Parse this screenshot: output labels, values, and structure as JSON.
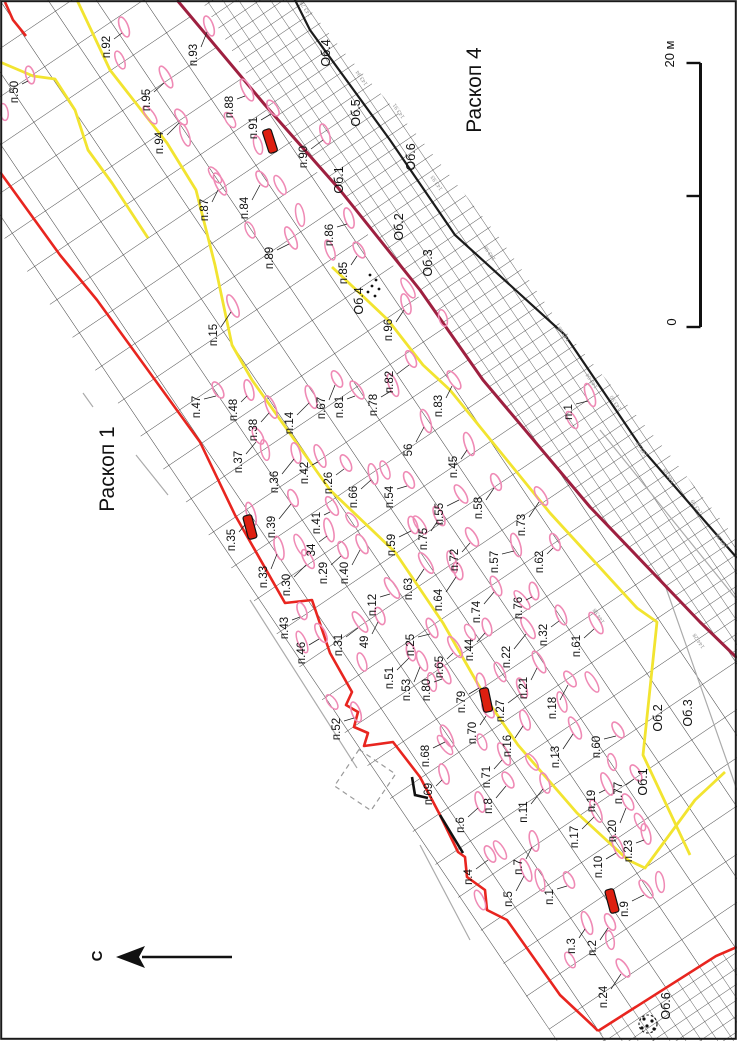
{
  "meta": {
    "width": 737,
    "height": 1041
  },
  "colors": {
    "red": "#e8251f",
    "maroon": "#9e2040",
    "yellow": "#f2e430",
    "pink": "#ef8ab5",
    "grid_big": "#3c3c3c",
    "grid_fine": "#333333",
    "gray": "#ababab",
    "text": "#111111",
    "elevation": "#9a9a9a",
    "red_fill": "#dd1f10"
  },
  "titles": [
    {
      "text": "Раскоп 1",
      "x": 114,
      "y": 469,
      "size": 21
    },
    {
      "text": "Раскоп 4",
      "x": 481,
      "y": 90,
      "size": 21
    }
  ],
  "north": {
    "label": "С",
    "x": 102,
    "y": 956,
    "shaft": [
      232,
      957,
      142,
      957
    ],
    "head": [
      [
        116,
        957
      ],
      [
        145,
        946
      ],
      [
        139,
        957
      ],
      [
        145,
        968
      ]
    ]
  },
  "scale_bar": {
    "x": 700.5,
    "y_top": 63,
    "y_mid": 196,
    "y_bottom": 327,
    "tick_len": 14,
    "label_top": "20 м",
    "label_top_x": 674,
    "label_top_y": 54,
    "label_bottom": "0",
    "label_bottom_x": 676,
    "label_bottom_y": 322
  },
  "grid": {
    "big_cell": 40,
    "fine_cell": 13.2,
    "angle": 56
  },
  "areas": {
    "big_grid": "0,0 177,0 470,360 737,640 737,1041 557,1041 -33,184",
    "fine_strip": "177,-40 265,105 340,190 420,290 483,380 590,507 700,622 737,658 737,540 669,454 562,327 499,237 419,137 344,52 270,-40",
    "fine_corner": "598,1031 716,956 737,947 737,1041 610,1041"
  },
  "lines": {
    "red_main": "0,172 60,255 97,300 150,373 200,442 235,515 285,603 312,600 330,653 352,692 346,705 358,712 354,727 368,733 364,746 393,742 420,777 440,815 458,852 465,857 467,877 485,890 487,910 507,920 560,995 592,1025 598,1031",
    "red_corner_seg": "5,2 13,20 26,36",
    "red_patch": "598,1031 716,956 737,947",
    "maroon_edge": "177,0 265,105 340,190 420,290 483,380 590,507 700,622 737,658",
    "dark_edge": "290,-10 310,30 390,140 455,235 565,335 643,450 723,542 737,558",
    "yellows": [
      "77,0 110,70 167,143 196,190 215,265 232,345 252,380 330,490 395,552 443,623 487,700 518,745 577,813 628,860 645,868 695,800 725,772",
      "0,62 33,76 55,79 75,110 88,150 112,183 148,238",
      "332,267 388,320 423,365 450,390 550,513 637,608 657,622 643,755 690,855"
    ],
    "grays": [
      "83,393 93,407",
      "136,455 168,495",
      "250,600 357,768",
      "420,845 470,940",
      "600,430 737,600",
      "665,585 737,790"
    ],
    "blacks": [
      "412,777 415,795 428,798",
      "440,815 463,853"
    ]
  },
  "dashed_square": {
    "x": 365,
    "y": 780,
    "size": 44,
    "angle": 34
  },
  "red_rects": [
    {
      "x": 270,
      "y": 141,
      "angle": -18
    },
    {
      "x": 250,
      "y": 527,
      "angle": -15
    },
    {
      "x": 486,
      "y": 700,
      "angle": -12
    },
    {
      "x": 612,
      "y": 901,
      "angle": -15
    }
  ],
  "dot_cluster": [
    [
      370,
      275
    ],
    [
      376,
      280
    ],
    [
      372,
      286
    ],
    [
      379,
      289
    ],
    [
      368,
      292
    ],
    [
      375,
      296
    ]
  ],
  "dotted_circle": {
    "x": 648,
    "y": 1024,
    "r": 9,
    "dots": [
      [
        644,
        1019
      ],
      [
        652,
        1021
      ],
      [
        647,
        1026
      ],
      [
        654,
        1029
      ],
      [
        642,
        1028
      ]
    ]
  },
  "burials": [
    {
      "t": "п.50",
      "x": 18,
      "y": 92
    },
    {
      "t": "п.92",
      "x": 110,
      "y": 47
    },
    {
      "t": "п.95",
      "x": 150,
      "y": 100
    },
    {
      "t": "п.94",
      "x": 163,
      "y": 143
    },
    {
      "t": "п.93",
      "x": 197,
      "y": 55
    },
    {
      "t": "п.88",
      "x": 233,
      "y": 107
    },
    {
      "t": "п.91",
      "x": 257,
      "y": 128
    },
    {
      "t": "п.90",
      "x": 307,
      "y": 157
    },
    {
      "t": "п.87",
      "x": 208,
      "y": 210
    },
    {
      "t": "п.84",
      "x": 248,
      "y": 208
    },
    {
      "t": "п.86",
      "x": 333,
      "y": 235
    },
    {
      "t": "п.89",
      "x": 273,
      "y": 258
    },
    {
      "t": "п.85",
      "x": 347,
      "y": 273
    },
    {
      "t": "п.96",
      "x": 392,
      "y": 330
    },
    {
      "t": "п.15",
      "x": 217,
      "y": 335
    },
    {
      "t": "п.47",
      "x": 200,
      "y": 407
    },
    {
      "t": "п.48",
      "x": 237,
      "y": 410
    },
    {
      "t": "п.38",
      "x": 257,
      "y": 430
    },
    {
      "t": "п.37",
      "x": 242,
      "y": 462
    },
    {
      "t": "п.36",
      "x": 278,
      "y": 482
    },
    {
      "t": "п.42",
      "x": 308,
      "y": 473
    },
    {
      "t": "п.26",
      "x": 332,
      "y": 483
    },
    {
      "t": "п.66",
      "x": 357,
      "y": 497
    },
    {
      "t": "п.14",
      "x": 293,
      "y": 423
    },
    {
      "t": "п.67",
      "x": 325,
      "y": 408
    },
    {
      "t": "п.81",
      "x": 343,
      "y": 407
    },
    {
      "t": "п.78",
      "x": 377,
      "y": 405
    },
    {
      "t": "п.82",
      "x": 393,
      "y": 382
    },
    {
      "t": "п.83",
      "x": 442,
      "y": 406
    },
    {
      "t": "56",
      "x": 412,
      "y": 450
    },
    {
      "t": "п.54",
      "x": 393,
      "y": 497
    },
    {
      "t": "п.55",
      "x": 443,
      "y": 514
    },
    {
      "t": "п.45",
      "x": 457,
      "y": 467
    },
    {
      "t": "п.58",
      "x": 482,
      "y": 508
    },
    {
      "t": "п.73",
      "x": 525,
      "y": 525
    },
    {
      "t": "п.57",
      "x": 498,
      "y": 562
    },
    {
      "t": "п.62",
      "x": 543,
      "y": 562
    },
    {
      "t": "п.72",
      "x": 458,
      "y": 560
    },
    {
      "t": "п.35",
      "x": 235,
      "y": 540
    },
    {
      "t": "п.39",
      "x": 275,
      "y": 527
    },
    {
      "t": "п.41",
      "x": 320,
      "y": 523
    },
    {
      "t": "34",
      "x": 315,
      "y": 550
    },
    {
      "t": "п.29",
      "x": 327,
      "y": 573
    },
    {
      "t": "п.30",
      "x": 290,
      "y": 585
    },
    {
      "t": "п.33",
      "x": 267,
      "y": 577
    },
    {
      "t": "п.43",
      "x": 288,
      "y": 628
    },
    {
      "t": "п.46",
      "x": 305,
      "y": 653
    },
    {
      "t": "п.31",
      "x": 342,
      "y": 645
    },
    {
      "t": "49",
      "x": 368,
      "y": 642
    },
    {
      "t": "п.40",
      "x": 348,
      "y": 573
    },
    {
      "t": "п.12",
      "x": 376,
      "y": 605
    },
    {
      "t": "п.59",
      "x": 395,
      "y": 545
    },
    {
      "t": "п.75",
      "x": 427,
      "y": 539
    },
    {
      "t": "п.63",
      "x": 412,
      "y": 589
    },
    {
      "t": "п.64",
      "x": 442,
      "y": 600
    },
    {
      "t": "п.25",
      "x": 414,
      "y": 645
    },
    {
      "t": "п.65",
      "x": 443,
      "y": 667
    },
    {
      "t": "п.44",
      "x": 473,
      "y": 650
    },
    {
      "t": "п.74",
      "x": 480,
      "y": 612
    },
    {
      "t": "п.22",
      "x": 510,
      "y": 657
    },
    {
      "t": "п.76",
      "x": 522,
      "y": 608
    },
    {
      "t": "п.32",
      "x": 547,
      "y": 635
    },
    {
      "t": "п.61",
      "x": 580,
      "y": 646
    },
    {
      "t": "п.51",
      "x": 393,
      "y": 678
    },
    {
      "t": "п.53",
      "x": 410,
      "y": 690
    },
    {
      "t": "п.80",
      "x": 430,
      "y": 690
    },
    {
      "t": "п.79",
      "x": 465,
      "y": 702
    },
    {
      "t": "п.27",
      "x": 504,
      "y": 711
    },
    {
      "t": "п.21",
      "x": 527,
      "y": 688
    },
    {
      "t": "п.18",
      "x": 556,
      "y": 708
    },
    {
      "t": "п.52",
      "x": 340,
      "y": 729
    },
    {
      "t": "п.68",
      "x": 429,
      "y": 756
    },
    {
      "t": "п.70",
      "x": 476,
      "y": 733
    },
    {
      "t": "п.16",
      "x": 511,
      "y": 746
    },
    {
      "t": "п.13",
      "x": 559,
      "y": 757
    },
    {
      "t": "п.60",
      "x": 600,
      "y": 747
    },
    {
      "t": "п.69",
      "x": 432,
      "y": 794
    },
    {
      "t": "п.71",
      "x": 490,
      "y": 777
    },
    {
      "t": "п.8",
      "x": 492,
      "y": 806
    },
    {
      "t": "п.11",
      "x": 527,
      "y": 812
    },
    {
      "t": "п.19",
      "x": 595,
      "y": 801
    },
    {
      "t": "п.77",
      "x": 622,
      "y": 793
    },
    {
      "t": "п.6",
      "x": 464,
      "y": 825
    },
    {
      "t": "п.17",
      "x": 578,
      "y": 837
    },
    {
      "t": "п.20",
      "x": 616,
      "y": 831
    },
    {
      "t": "п.23",
      "x": 632,
      "y": 851
    },
    {
      "t": "п.10",
      "x": 602,
      "y": 867
    },
    {
      "t": "п.4",
      "x": 472,
      "y": 877
    },
    {
      "t": "п.7",
      "x": 522,
      "y": 867
    },
    {
      "t": "п.5",
      "x": 512,
      "y": 899
    },
    {
      "t": "п.1",
      "x": 553,
      "y": 897
    },
    {
      "t": "п.9",
      "x": 628,
      "y": 909
    },
    {
      "t": "п.3",
      "x": 575,
      "y": 946
    },
    {
      "t": "п.2",
      "x": 596,
      "y": 948
    },
    {
      "t": "п.24",
      "x": 607,
      "y": 997
    },
    {
      "t": "п.1",
      "x": 572,
      "y": 412
    }
  ],
  "objects": [
    {
      "t": "Об.4",
      "x": 330,
      "y": 53
    },
    {
      "t": "Об.5",
      "x": 360,
      "y": 113
    },
    {
      "t": "Об.1",
      "x": 343,
      "y": 180
    },
    {
      "t": "Об.6",
      "x": 415,
      "y": 157
    },
    {
      "t": "Об.2",
      "x": 403,
      "y": 227
    },
    {
      "t": "Об.3",
      "x": 432,
      "y": 263
    },
    {
      "t": "Об.4",
      "x": 363,
      "y": 301
    },
    {
      "t": "Об.2",
      "x": 662,
      "y": 718
    },
    {
      "t": "Об.3",
      "x": 692,
      "y": 713
    },
    {
      "t": "Об.1",
      "x": 647,
      "y": 782
    },
    {
      "t": "Об.6",
      "x": 670,
      "y": 1006
    }
  ],
  "elevations": [
    {
      "t": "143.78",
      "x": 307,
      "y": 8
    },
    {
      "t": "143.94",
      "x": 363,
      "y": 77
    },
    {
      "t": "143.91",
      "x": 400,
      "y": 110
    },
    {
      "t": "143.93",
      "x": 438,
      "y": 182
    },
    {
      "t": "143.98",
      "x": 491,
      "y": 252
    },
    {
      "t": "143.98",
      "x": 565,
      "y": 333
    },
    {
      "t": "143.64",
      "x": 593,
      "y": 380
    },
    {
      "t": "143.90",
      "x": 617,
      "y": 402
    },
    {
      "t": "145.02",
      "x": 643,
      "y": 448
    },
    {
      "t": "144.38",
      "x": 670,
      "y": 475
    },
    {
      "t": "143.99",
      "x": 698,
      "y": 506
    },
    {
      "t": "145.38",
      "x": 723,
      "y": 540
    },
    {
      "t": "144.58",
      "x": 600,
      "y": 615
    },
    {
      "t": "144.28",
      "x": 700,
      "y": 640
    }
  ],
  "extra_graves": [
    [
      4,
      112
    ],
    [
      120,
      60
    ],
    [
      150,
      115
    ],
    [
      185,
      135
    ],
    [
      230,
      120
    ],
    [
      258,
      145
    ],
    [
      280,
      185
    ],
    [
      300,
      215
    ],
    [
      250,
      230
    ],
    [
      215,
      175
    ],
    [
      330,
      250
    ],
    [
      408,
      288
    ],
    [
      443,
      318
    ],
    [
      572,
      420
    ],
    [
      265,
      450
    ],
    [
      300,
      545
    ],
    [
      352,
      520
    ],
    [
      385,
      470
    ],
    [
      420,
      525
    ],
    [
      452,
      562
    ],
    [
      470,
      632
    ],
    [
      432,
      682
    ],
    [
      500,
      672
    ],
    [
      522,
      600
    ],
    [
      482,
      742
    ],
    [
      532,
      762
    ],
    [
      562,
      702
    ],
    [
      592,
      682
    ],
    [
      612,
      762
    ],
    [
      640,
      822
    ],
    [
      660,
      882
    ],
    [
      302,
      642
    ],
    [
      332,
      702
    ],
    [
      362,
      662
    ],
    [
      500,
      850
    ],
    [
      540,
      880
    ],
    [
      570,
      960
    ],
    [
      610,
      940
    ],
    [
      480,
      900
    ],
    [
      445,
      745
    ]
  ]
}
